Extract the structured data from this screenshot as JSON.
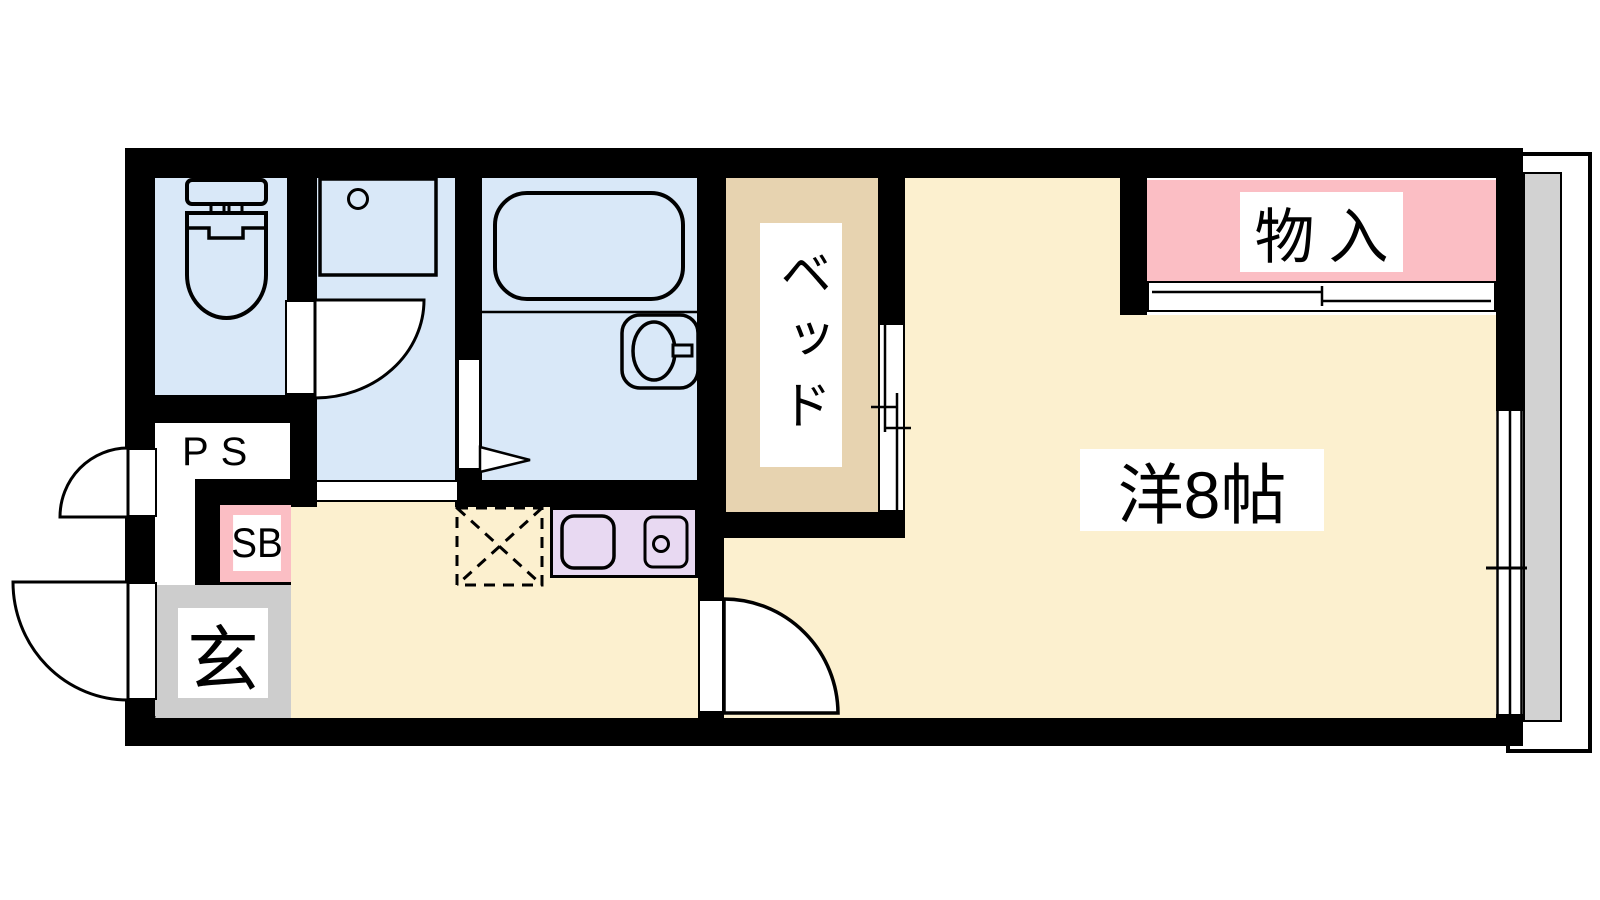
{
  "title": "1R apartment floor plan",
  "rooms": {
    "main_room": {
      "label": "洋8帖"
    },
    "bed_alcove": {
      "label": "ベッド"
    },
    "closet": {
      "label": "物入"
    },
    "entrance": {
      "label": "玄"
    },
    "shoe_box": {
      "label": "SB"
    },
    "pipe_space": {
      "label": "PS"
    }
  },
  "fixtures": [
    "toilet",
    "washing-machine-pan",
    "bathtub",
    "washbasin",
    "kitchen-sink",
    "stove",
    "refrigerator-space",
    "sliding-closet-door",
    "sliding-window",
    "entrance-door",
    "interior-doors",
    "balcony"
  ],
  "colors": {
    "wall": "#000000",
    "wet_area_floor": "#d9e8f8",
    "living_floor": "#fcf0cf",
    "bed_floor": "#e7d3b0",
    "closet_fill": "#fbbec4",
    "kitchen_counter": "#e8d9f2",
    "entrance_floor": "#cdcdcd",
    "balcony_strip": "#d2d2d2",
    "label_background": "#ffffff"
  }
}
